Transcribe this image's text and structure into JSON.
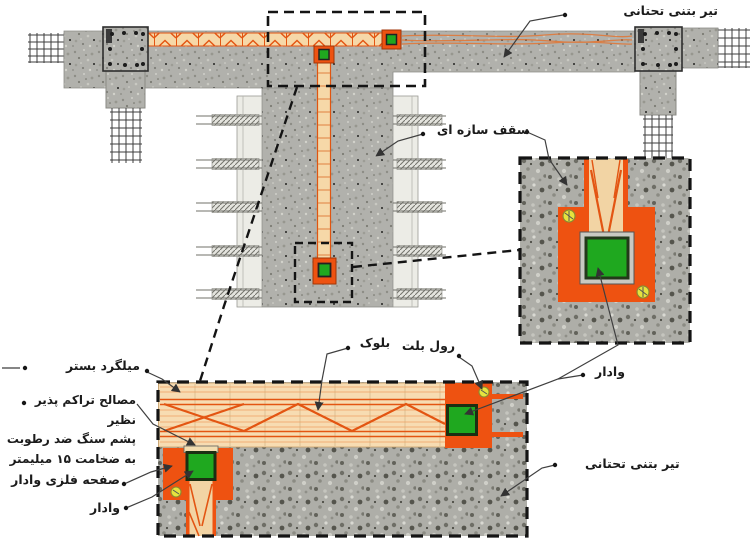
{
  "labels": {
    "top_beam": "تیر بتنی تحتانی",
    "structural_ceiling": "سقف سازه ای",
    "bed_rebar": "میلگرد بستر",
    "compressible_1": "مصالح تراکم پذیر نظیر",
    "compressible_2": "پشم سنگ ضد رطوبت",
    "compressible_3": "به ضخامت ۱۵ میلیمتر",
    "block": "بلوک",
    "roll_bolt": "رول بلت",
    "stud_right": "وادار",
    "stud_plate": "صفحه فلزی وادار",
    "stud_left": "وادار",
    "bottom_beam": "تیر بتنی تحتانی"
  },
  "colors": {
    "plate_orange": "#ee5211",
    "stud_green": "#1fa81f",
    "wood_tan": "#f6d8a8",
    "concrete_gray": "#b1b1ac",
    "screw_yellow": "#e6e23e",
    "truss_orange": "#e35512"
  }
}
